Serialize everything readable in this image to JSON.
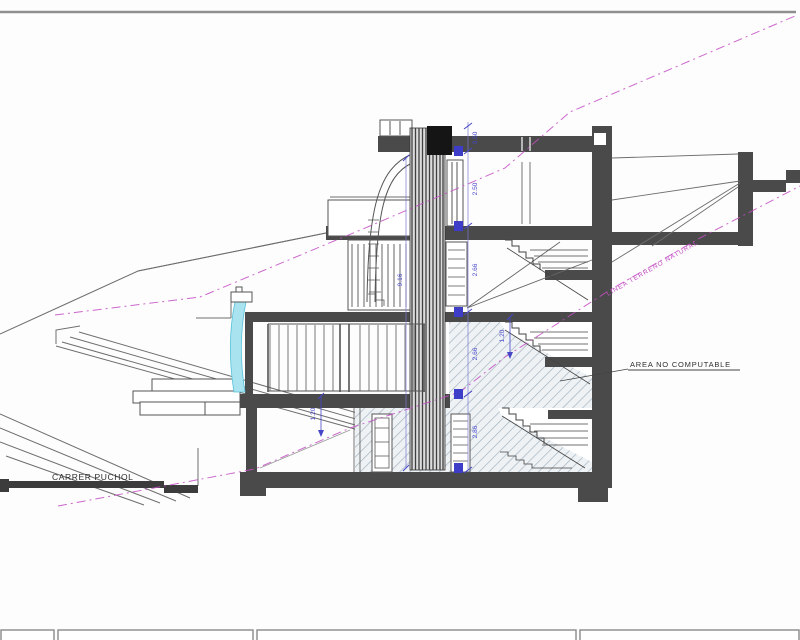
{
  "drawing": {
    "street_label": "CARRER PUCHOL",
    "area_label": "AREA NO COMPUTABLE",
    "terrain_label": "LINEA TERRENO NATURAL",
    "dims": {
      "parapet": "0.50",
      "top_floor": "2.50",
      "second_floor": "2.66",
      "first_floor": "2.66",
      "basement": "2.86",
      "total": "9.16",
      "terrace": "1.20",
      "stair": "1.20"
    },
    "colors": {
      "structure": "#4a4a4a",
      "terrain_line": "#c34ec3",
      "dimension": "#4646c8",
      "water": "#a9e3f0",
      "hatch": "#a7b4c0"
    }
  }
}
